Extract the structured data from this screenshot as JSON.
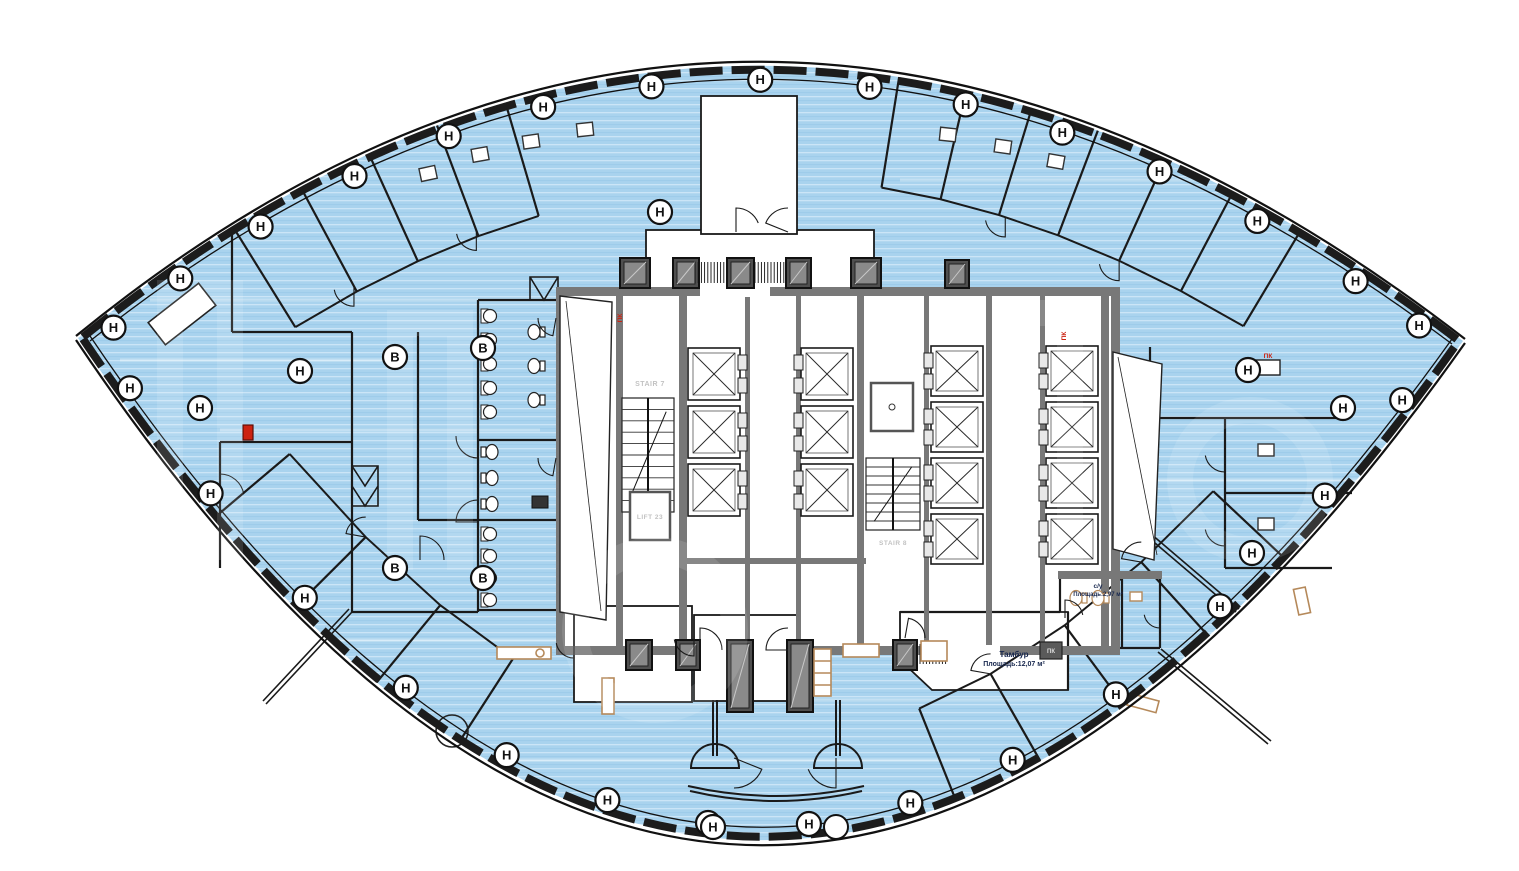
{
  "document": {
    "kind": "architectural-floor-plan",
    "language": "ru"
  },
  "labels": {
    "tambour_name": "Тамбур",
    "tambour_area": "Площадь:12,07 м²",
    "wc_name": "с/у",
    "wc_area": "Площадь:2,97 м²",
    "stair7": "STAIR 7",
    "lift23": "LIFT 23",
    "stair8": "STAIR 8",
    "fire_cabinet": "ПК"
  },
  "markers": {
    "perimeter_letter": "Н",
    "interior_letter": "В"
  },
  "colors": {
    "floor_fill": "#a9d3ee",
    "floor_stripe_light": "#cbe5f7",
    "floor_stripe_dark": "#8fc3e4",
    "wall": "#1a1a1a",
    "core_wall": "#787878",
    "shaft_dark": "#4f4f4f",
    "shaft_face": "#8a8a8a",
    "furniture": "#b5895a",
    "alert_red": "#cc2211",
    "label_text": "#16264d",
    "core_label_text": "#c2c2c2",
    "door_leaf": "#e8e8e8"
  }
}
